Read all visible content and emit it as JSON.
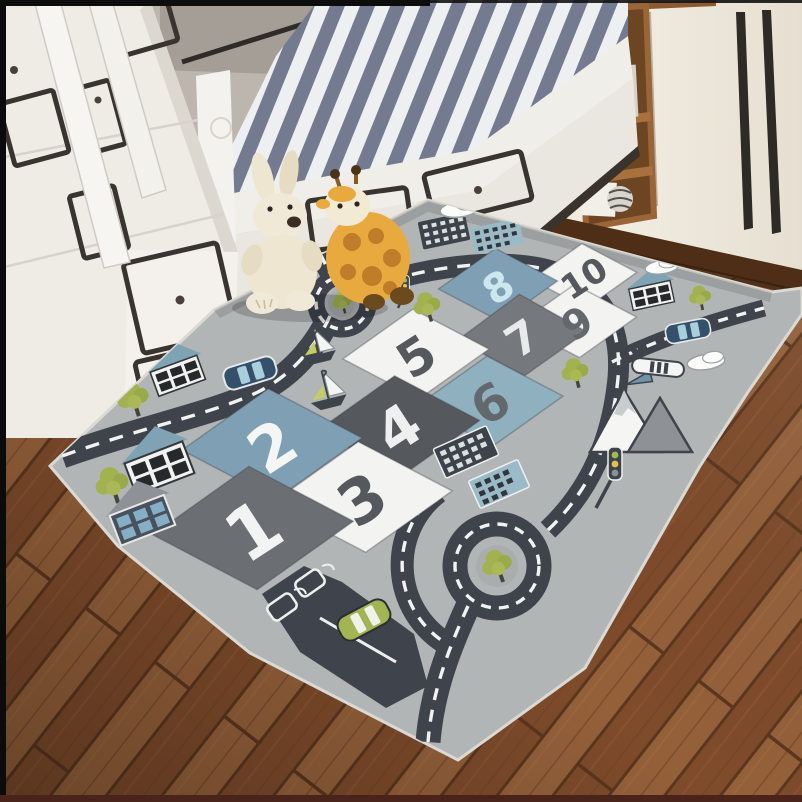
{
  "scene": {
    "room": {
      "wall_color": "#bcb6af",
      "floor_color": "#8a5433",
      "furniture_color": "#efece6",
      "mattress_stripe_color": "#767d92",
      "wardrobe_wood_color": "#8a5a30",
      "plinth_color": "#4e2e17"
    },
    "toys": [
      {
        "name": "bunny-plush",
        "color": "#efe6d2"
      },
      {
        "name": "giraffe-plush",
        "color": "#e8a93e"
      }
    ]
  },
  "rug": {
    "base_color": "#b2b5b6",
    "edge_color": "#dbd9d3",
    "road_color": "#3f444c",
    "road_line_color": "#f2f2f2",
    "tree_color": "#a3b251",
    "squares": [
      {
        "number": "1",
        "color": "#6b6e72",
        "number_color": "#f2f3f3"
      },
      {
        "number": "2",
        "color": "#7fa0b4",
        "number_color": "#f4f6f6"
      },
      {
        "number": "3",
        "color": "#f3f3f1",
        "number_color": "#55595e"
      },
      {
        "number": "4",
        "color": "#55585d",
        "number_color": "#eef0f0"
      },
      {
        "number": "5",
        "color": "#f3f3f1",
        "number_color": "#55595e"
      },
      {
        "number": "6",
        "color": "#8fb0bf",
        "number_color": "#63686d"
      },
      {
        "number": "7",
        "color": "#75797e",
        "number_color": "#e8eaea"
      },
      {
        "number": "8",
        "color": "#7fa0b4",
        "number_color": "#cde7ef"
      },
      {
        "number": "9",
        "color": "#f3f3f1",
        "number_color": "#63686d"
      },
      {
        "number": "10",
        "color": "#f3f3f1",
        "number_color": "#55595e"
      }
    ],
    "icons": [
      "tree-icon",
      "house-icon",
      "building-icon",
      "car-icon",
      "sailboat-icon",
      "cloud-icon",
      "mountain-icon",
      "airplane-icon",
      "traffic-light-icon",
      "roundabout-icon",
      "gas-station-icon"
    ]
  }
}
